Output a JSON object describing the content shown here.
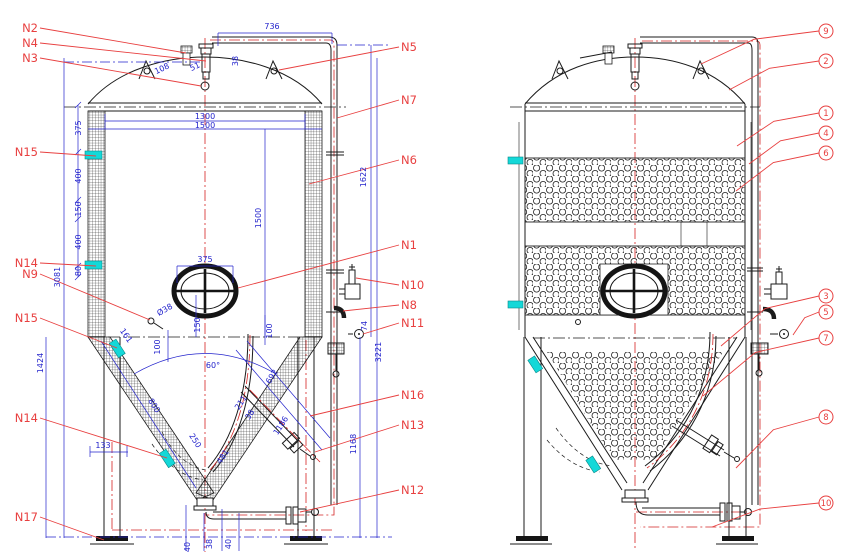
{
  "colors": {
    "dim_text": "#2323cc",
    "label_red": "#e84040",
    "centerline": "#d42424",
    "cyan": "#14d8d8",
    "black": "#1b1b1b"
  },
  "nozzles_left": [
    {
      "t": "N2",
      "x": 40,
      "y": 28,
      "tx": 186,
      "ty": 53
    },
    {
      "t": "N4",
      "x": 40,
      "y": 43,
      "tx": 206,
      "ty": 61
    },
    {
      "t": "N3",
      "x": 40,
      "y": 58,
      "tx": 201,
      "ty": 86
    },
    {
      "t": "N15",
      "x": 40,
      "y": 152,
      "tx": 96,
      "ty": 156
    },
    {
      "t": "N14",
      "x": 40,
      "y": 263,
      "tx": 96,
      "ty": 266
    },
    {
      "t": "N9",
      "x": 40,
      "y": 274,
      "tx": 150,
      "ty": 320
    },
    {
      "t": "N15",
      "x": 40,
      "y": 318,
      "tx": 117,
      "ty": 348
    },
    {
      "t": "N14",
      "x": 40,
      "y": 418,
      "tx": 167,
      "ty": 458
    },
    {
      "t": "N17",
      "x": 40,
      "y": 517,
      "tx": 104,
      "ty": 540
    }
  ],
  "nozzles_right": [
    {
      "t": "N5",
      "x": 399,
      "y": 47,
      "tx": 279,
      "ty": 70
    },
    {
      "t": "N7",
      "x": 399,
      "y": 100,
      "tx": 337,
      "ty": 118
    },
    {
      "t": "N6",
      "x": 399,
      "y": 160,
      "tx": 309,
      "ty": 184
    },
    {
      "t": "N1",
      "x": 399,
      "y": 245,
      "tx": 238,
      "ty": 288
    },
    {
      "t": "N10",
      "x": 399,
      "y": 285,
      "tx": 356,
      "ty": 278
    },
    {
      "t": "N8",
      "x": 399,
      "y": 305,
      "tx": 343,
      "ty": 311
    },
    {
      "t": "N11",
      "x": 399,
      "y": 323,
      "tx": 363,
      "ty": 334
    },
    {
      "t": "N16",
      "x": 399,
      "y": 395,
      "tx": 310,
      "ty": 416
    },
    {
      "t": "N13",
      "x": 399,
      "y": 425,
      "tx": 315,
      "ty": 452
    },
    {
      "t": "N12",
      "x": 399,
      "y": 490,
      "tx": 300,
      "ty": 512
    }
  ],
  "callouts": [
    {
      "t": "9",
      "y": 31,
      "tx": 701,
      "ty": 64
    },
    {
      "t": "2",
      "y": 61,
      "tx": 729,
      "ty": 90
    },
    {
      "t": "1",
      "y": 113,
      "tx": 737,
      "ty": 146
    },
    {
      "t": "4",
      "y": 133,
      "tx": 749,
      "ty": 164
    },
    {
      "t": "6",
      "y": 153,
      "tx": 736,
      "ty": 191
    },
    {
      "t": "3",
      "y": 296,
      "tx": 721,
      "ty": 346
    },
    {
      "t": "5",
      "y": 312,
      "tx": 793,
      "ty": 335
    },
    {
      "t": "7",
      "y": 338,
      "tx": 703,
      "ty": 396
    },
    {
      "t": "8",
      "y": 417,
      "tx": 736,
      "ty": 468
    },
    {
      "t": "10",
      "y": 503,
      "tx": 712,
      "ty": 527
    }
  ],
  "balloon_x": 826,
  "dimensions": [
    {
      "t": "736",
      "x": 272,
      "y": 29
    },
    {
      "t": "38",
      "x": 238,
      "y": 61,
      "r": -90
    },
    {
      "t": "108",
      "x": 163,
      "y": 71,
      "r": -25
    },
    {
      "t": "51",
      "x": 196,
      "y": 69,
      "r": -25
    },
    {
      "t": "1300",
      "x": 205,
      "y": 119
    },
    {
      "t": "1500",
      "x": 205,
      "y": 128
    },
    {
      "t": "375",
      "x": 81,
      "y": 128,
      "r": -90
    },
    {
      "t": "400",
      "x": 81,
      "y": 176,
      "r": -90
    },
    {
      "t": "150",
      "x": 81,
      "y": 209,
      "r": -90
    },
    {
      "t": "400",
      "x": 81,
      "y": 242,
      "r": -90
    },
    {
      "t": "80",
      "x": 81,
      "y": 271,
      "r": -90
    },
    {
      "t": "3081",
      "x": 60,
      "y": 277,
      "r": -90
    },
    {
      "t": "1424",
      "x": 43,
      "y": 363,
      "r": -90
    },
    {
      "t": "1500",
      "x": 261,
      "y": 218,
      "r": -90
    },
    {
      "t": "1622",
      "x": 366,
      "y": 177,
      "r": -90
    },
    {
      "t": "3221",
      "x": 381,
      "y": 352,
      "r": -90
    },
    {
      "t": "1168",
      "x": 356,
      "y": 444,
      "r": -90
    },
    {
      "t": "74",
      "x": 367,
      "y": 326,
      "r": -90
    },
    {
      "t": "375",
      "x": 205,
      "y": 262
    },
    {
      "t": "Ø38",
      "x": 166,
      "y": 312,
      "r": -30
    },
    {
      "t": "150",
      "x": 200,
      "y": 325,
      "r": -90
    },
    {
      "t": "100",
      "x": 160,
      "y": 347,
      "r": -90
    },
    {
      "t": "100",
      "x": 272,
      "y": 331,
      "r": -90
    },
    {
      "t": "161",
      "x": 124,
      "y": 337,
      "r": 55
    },
    {
      "t": "60°",
      "x": 213,
      "y": 368
    },
    {
      "t": "800",
      "x": 152,
      "y": 407,
      "r": 57
    },
    {
      "t": "250",
      "x": 193,
      "y": 442,
      "r": 57
    },
    {
      "t": "481",
      "x": 225,
      "y": 458,
      "r": -57
    },
    {
      "t": "211",
      "x": 243,
      "y": 404,
      "r": -57
    },
    {
      "t": "38",
      "x": 252,
      "y": 416,
      "r": -57
    },
    {
      "t": "692",
      "x": 274,
      "y": 378,
      "r": -57
    },
    {
      "t": "1186",
      "x": 283,
      "y": 427,
      "r": -57
    },
    {
      "t": "133",
      "x": 103,
      "y": 448
    },
    {
      "t": "40",
      "x": 190,
      "y": 547,
      "r": -90
    },
    {
      "t": "38",
      "x": 212,
      "y": 544,
      "r": -90
    },
    {
      "t": "40",
      "x": 231,
      "y": 544,
      "r": -90
    }
  ]
}
